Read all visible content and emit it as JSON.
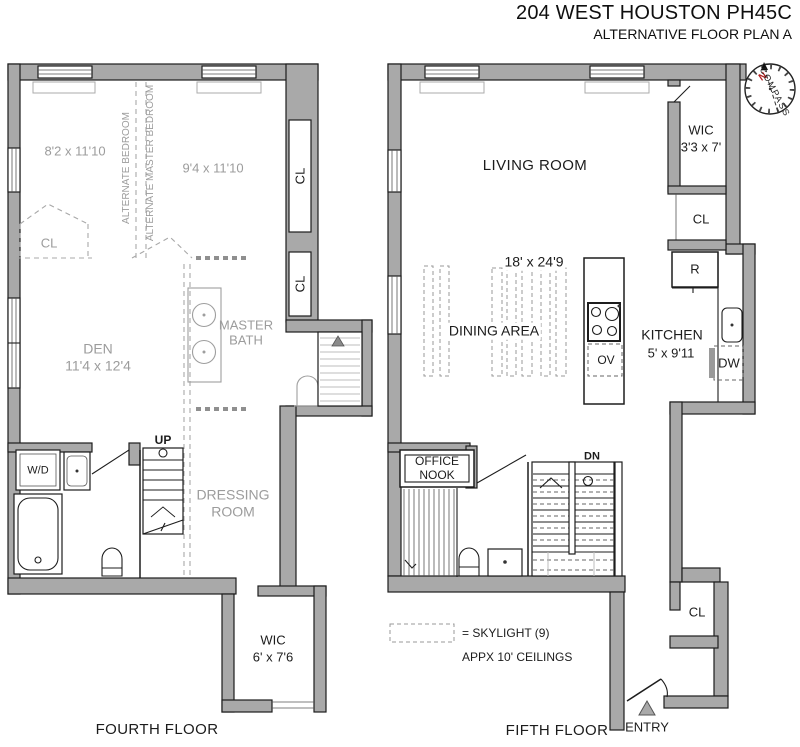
{
  "header": {
    "title": "204 WEST HOUSTON PH45C",
    "subtitle": "ALTERNATIVE FLOOR PLAN A"
  },
  "compass": {
    "label": "COMPASS",
    "north": "N"
  },
  "fourth_floor": {
    "floor_label": "FOURTH FLOOR",
    "alt_bedroom_dim": "8'2 x 11'10",
    "alt_master_dim": "9'4 x 11'10",
    "alt_bedroom": "ALTERNATE BEDROOM",
    "alt_master_bedroom": "ALTERNATE MASTER BEDROOM",
    "closet_dashed": "CL",
    "closet_right_upper": "CL",
    "closet_right_lower": "CL",
    "den": "DEN",
    "den_dim": "11'4 x 12'4",
    "master_bath": "MASTER BATH",
    "washer_dryer": "W/D",
    "stairs_up": "UP",
    "dressing_room": "DRESSING ROOM",
    "wic": "WIC",
    "wic_dim": "6' x 7'6"
  },
  "fifth_floor": {
    "floor_label": "FIFTH FLOOR",
    "living_room": "LIVING ROOM",
    "wic": "WIC",
    "wic_dim": "3'3 x 7'",
    "closet_upper": "CL",
    "refrigerator": "R",
    "overall_dim": "18' x 24'9",
    "dining_area": "DINING AREA",
    "kitchen": "KITCHEN",
    "kitchen_dim": "5' x 9'11",
    "oven": "OV",
    "dishwasher": "DW",
    "office_nook": "OFFICE NOOK",
    "stairs_down": "DN",
    "closet_lower": "CL",
    "entry": "ENTRY"
  },
  "legend": {
    "skylight": "= SKYLIGHT (9)",
    "ceilings": "APPX 10' CEILINGS"
  },
  "colors": {
    "wall": "#a9a9a9",
    "line": "#1d1d1d",
    "ghost": "#9e9e9e",
    "north": "#b32222"
  }
}
